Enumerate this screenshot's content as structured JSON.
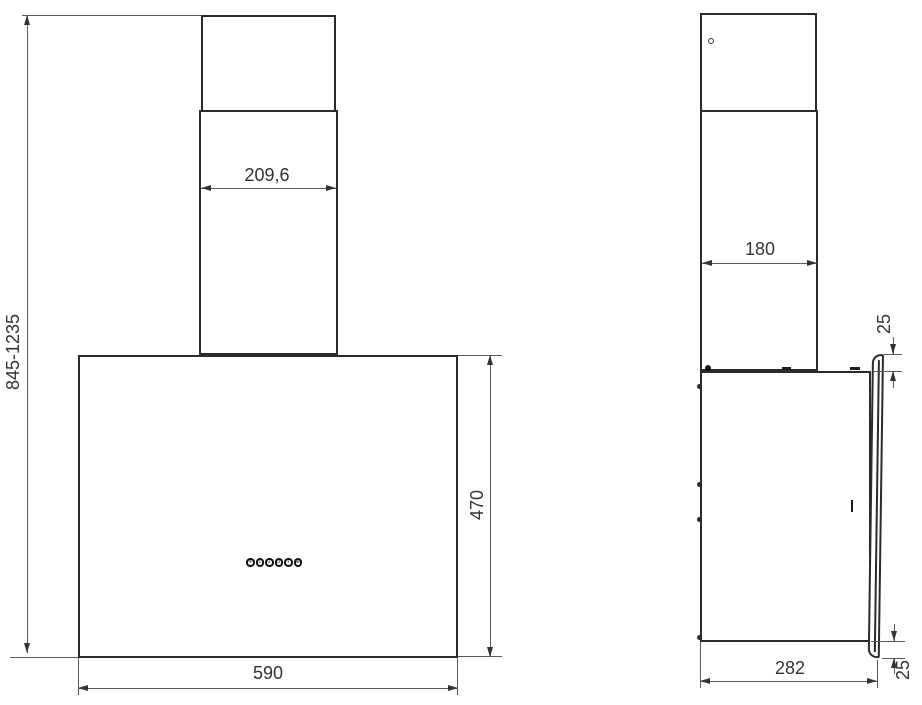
{
  "diagram": {
    "type": "technical-dimension-drawing",
    "subject": "wall-mounted cooker hood, front and side elevation with dimensions (mm)",
    "background_color": "#ffffff",
    "outline_color": "#2b2b2b",
    "dimension_line_color": "#5a5a5a",
    "text_color": "#333333"
  },
  "front_view": {
    "name": "front elevation",
    "dims": {
      "chimney_width": "209,6",
      "overall_height_range": "845-1235",
      "body_height": "470",
      "body_width": "590"
    },
    "control_buttons": [
      {
        "name": "light-button",
        "glyph": "✳"
      },
      {
        "name": "speed-1-button",
        "glyph": "1"
      },
      {
        "name": "speed-2-button",
        "glyph": "2"
      },
      {
        "name": "speed-3-button",
        "glyph": "3"
      },
      {
        "name": "off-button",
        "glyph": "▪"
      },
      {
        "name": "timer-button",
        "glyph": "⊕"
      }
    ]
  },
  "side_view": {
    "name": "side elevation",
    "dims": {
      "chimney_depth": "180",
      "panel_top_offset": "25",
      "body_depth": "282",
      "panel_bottom_offset": "25"
    }
  }
}
